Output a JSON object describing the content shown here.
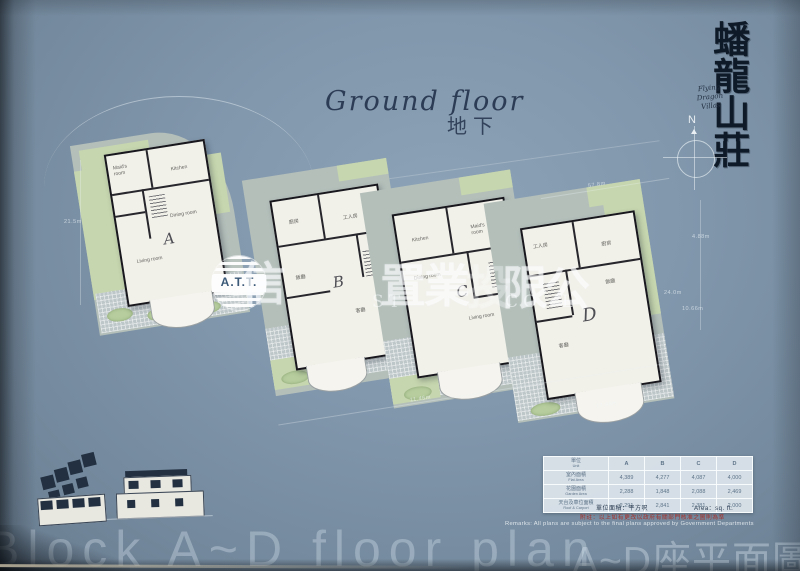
{
  "page": {
    "title_en": "Ground floor",
    "title_zh": "地下"
  },
  "branding": {
    "calligraphy": "蟠龍山莊",
    "script_name": "Flying Dragon\nVillas",
    "compass": "N"
  },
  "watermark": {
    "logo": "A.T.T.",
    "cn": [
      "信",
      "置",
      "業",
      "投",
      "限",
      "公"
    ],
    "en": [
      "T",
      "ST",
      "CO. L"
    ]
  },
  "plans": [
    {
      "letter": "A",
      "rooms": {
        "top_left": "Maid's\nroom",
        "top_right": "Kitchen",
        "mid": "Dining room",
        "lower": "Living room"
      }
    },
    {
      "letter": "B",
      "rooms": {
        "top_left": "廚房",
        "top_right": "工人房",
        "mid": "飯廳",
        "lower": "客廳"
      }
    },
    {
      "letter": "C",
      "rooms": {
        "top_left": "Kitchen",
        "top_right": "Maid's\nroom",
        "mid": "Dining room",
        "lower": "Living room"
      }
    },
    {
      "letter": "D",
      "rooms": {
        "top_left": "工人房",
        "top_right": "廚房",
        "mid": "飯廳",
        "lower": "客廳"
      }
    }
  ],
  "dimensions": [
    "21.5m",
    "57.8m",
    "4.88m",
    "24.0m",
    "10.66m",
    "11.46m",
    "17.46m"
  ],
  "table": {
    "unit_zh": "單位",
    "unit_en": "Unit",
    "columns": [
      "A",
      "B",
      "C",
      "D"
    ],
    "rows": [
      {
        "label_zh": "室內面積",
        "label_en": "Flat Area",
        "values": [
          "4,389",
          "4,277",
          "4,087",
          "4,000"
        ]
      },
      {
        "label_zh": "花園面積",
        "label_en": "Garden Area",
        "values": [
          "2,288",
          "1,848",
          "2,088",
          "2,469"
        ]
      },
      {
        "label_zh": "天台及車位面積",
        "label_en": "Roof & Carport",
        "values": [
          "2,291",
          "2,841",
          "2,381",
          "2,000"
        ]
      }
    ],
    "area_unit_zh": "單位面積：平方呎",
    "area_unit_en": "Area：sq. ft."
  },
  "notes": {
    "red_zh": "附註：以上如有更改以政府有關部門核准之圖則為準",
    "remark_en": "Remarks: All plans are subject to the final plans approved by Government Departments"
  },
  "footer": {
    "en": "Block A~D floor plan",
    "zh": "A~D座平面圖"
  }
}
